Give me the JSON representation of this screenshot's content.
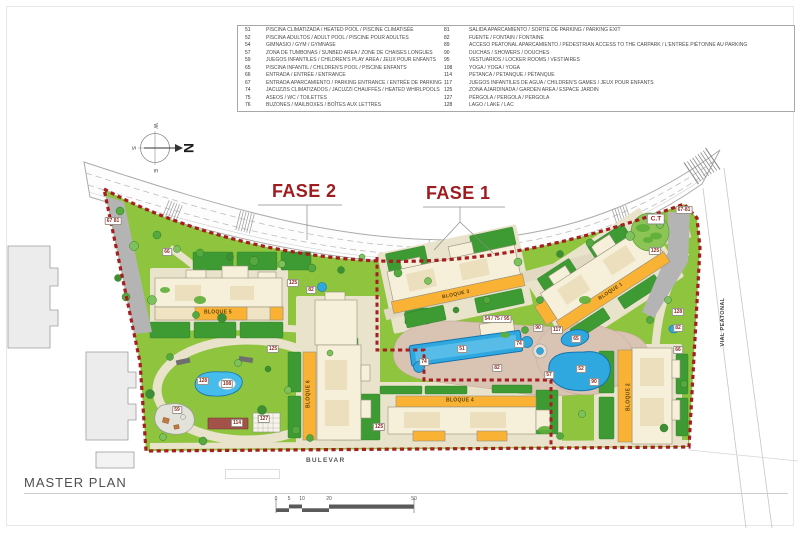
{
  "page": {
    "title": "MASTER PLAN"
  },
  "phases": {
    "fase1": "FASE 1",
    "fase2": "FASE 2"
  },
  "compass": {
    "n": "N",
    "s": "S",
    "e": "E",
    "w": "W"
  },
  "streets": {
    "bottom": "BULEVAR",
    "right": "VIAL PEATONAL"
  },
  "legend": {
    "left": [
      {
        "num": "51",
        "text": "PISCINA CLIMATIZADA / HEATED POOL / PISCINE CLIMATISÉE"
      },
      {
        "num": "52",
        "text": "PISCINA ADULTOS / ADULT POOL / PISCINE POUR ADULTES"
      },
      {
        "num": "54",
        "text": "GIMNASIO / GYM / GYMNASE"
      },
      {
        "num": "57",
        "text": "ZONA DE TUMBONAS / SUNBED AREA / ZONE DE CHAISES LONGUES"
      },
      {
        "num": "59",
        "text": "JUEGOS INFANTILES / CHILDREN'S PLAY AREA / JEUX POUR ENFANTS"
      },
      {
        "num": "65",
        "text": "PISCINA INFANTIL / CHILDREN'S POOL / PISCINE ENFANTS"
      },
      {
        "num": "66",
        "text": "ENTRADA / ENTRÉE / ENTRANCE"
      },
      {
        "num": "67",
        "text": "ENTRADA APARCAMIENTO / PARKING ENTRANCE / ENTRÉE DE PARKING"
      },
      {
        "num": "74",
        "text": "JACUZZIS CLIMATIZADOS / JACUZZI CHAUFFÉS / HEATED WHIRLPOOLS"
      },
      {
        "num": "75",
        "text": "ASEOS / WC / TOILETTES"
      },
      {
        "num": "76",
        "text": "BUZONES / MAILBOXES / BOÎTES AUX LETTRES"
      }
    ],
    "right": [
      {
        "num": "81",
        "text": "SALIDA APARCAMIENTO / SORTIE DE PARKING / PARKING EXIT"
      },
      {
        "num": "82",
        "text": "FUENTE / FONTAIN / FONTAINE"
      },
      {
        "num": "89",
        "text": "ACCESO PEATONAL APARCAMIENTO / PEDESTRIAN ACCESS TO THE CARPARK / L'ENTRÉE PIÉTONNE AU PARKING"
      },
      {
        "num": "90",
        "text": "DUCHAS / SHOWERS / DOUCHES"
      },
      {
        "num": "95",
        "text": "VESTUARIOS / LOCKER ROOMS / VESTIAIRES"
      },
      {
        "num": "108",
        "text": "YOGA / YOGA / YOGA"
      },
      {
        "num": "114",
        "text": "PETANCA / PETANQUE / PÉTANQUE"
      },
      {
        "num": "117",
        "text": "JUEGOS INFANTILES DE AGUA / CHILDREN'S GAMES / JEUX POUR ENFANTS"
      },
      {
        "num": "125",
        "text": "ZONA AJARDINADA / GARDEN AREA / ESPACE JARDIN"
      },
      {
        "num": "127",
        "text": "PÉRGOLA / PERGOLA / PERGOLA"
      },
      {
        "num": "128",
        "text": "LAGO / LAKE / LAC"
      }
    ]
  },
  "map": {
    "buildings": [
      {
        "label": "BLOQUE 5",
        "x": 218,
        "y": 313,
        "angle": 0
      },
      {
        "label": "BLOQUE 6",
        "x": 309,
        "y": 394,
        "angle": -90
      },
      {
        "label": "BLOQUE 3",
        "x": 456,
        "y": 295,
        "angle": -12
      },
      {
        "label": "BLOQUE 1",
        "x": 611,
        "y": 292,
        "angle": -33
      },
      {
        "label": "BLOQUE 2",
        "x": 629,
        "y": 397,
        "angle": -90
      },
      {
        "label": "BLOQUE 4",
        "x": 460,
        "y": 401,
        "angle": 0
      }
    ],
    "chips": [
      {
        "t": "67 81",
        "x": 113,
        "y": 221
      },
      {
        "t": "66",
        "x": 167,
        "y": 252
      },
      {
        "t": "125",
        "x": 293,
        "y": 283
      },
      {
        "t": "82",
        "x": 311,
        "y": 290
      },
      {
        "t": "125",
        "x": 273,
        "y": 349
      },
      {
        "t": "128",
        "x": 203,
        "y": 381
      },
      {
        "t": "108",
        "x": 227,
        "y": 384
      },
      {
        "t": "59",
        "x": 177,
        "y": 410
      },
      {
        "t": "114",
        "x": 237,
        "y": 423
      },
      {
        "t": "127",
        "x": 264,
        "y": 419
      },
      {
        "t": "125",
        "x": 379,
        "y": 427
      },
      {
        "t": "54 / 75 / 95",
        "x": 497,
        "y": 319
      },
      {
        "t": "90",
        "x": 538,
        "y": 328
      },
      {
        "t": "117",
        "x": 557,
        "y": 330
      },
      {
        "t": "51",
        "x": 462,
        "y": 349
      },
      {
        "t": "74",
        "x": 424,
        "y": 362
      },
      {
        "t": "74",
        "x": 519,
        "y": 344
      },
      {
        "t": "82",
        "x": 497,
        "y": 368
      },
      {
        "t": "57",
        "x": 549,
        "y": 375
      },
      {
        "t": "65",
        "x": 576,
        "y": 339
      },
      {
        "t": "52",
        "x": 581,
        "y": 369
      },
      {
        "t": "90",
        "x": 594,
        "y": 382
      },
      {
        "t": "128",
        "x": 678,
        "y": 312
      },
      {
        "t": "82",
        "x": 678,
        "y": 328
      },
      {
        "t": "66",
        "x": 678,
        "y": 350
      },
      {
        "t": "125",
        "x": 655,
        "y": 251
      },
      {
        "t": "67-81",
        "x": 684,
        "y": 210
      },
      {
        "t": "C.T",
        "x": 656,
        "y": 219,
        "big": true
      }
    ]
  },
  "scalebar": {
    "ticks": [
      {
        "v": "0",
        "x": 276
      },
      {
        "v": "5",
        "x": 289
      },
      {
        "v": "10",
        "x": 302
      },
      {
        "v": "20",
        "x": 329
      },
      {
        "v": "50",
        "x": 414
      }
    ]
  },
  "colors": {
    "boundary_red": "#A51E22",
    "fase_text": "#9E1B1E",
    "site_green": "#8EC43E",
    "lawn_dark_green": "#3E9B33",
    "pool_blue": "#2FA8E0",
    "building_cream": "#F6EFD9",
    "building_orange": "#F9B233",
    "deck_pink": "#D9C3B3",
    "path_beige": "#E9E3CC"
  }
}
